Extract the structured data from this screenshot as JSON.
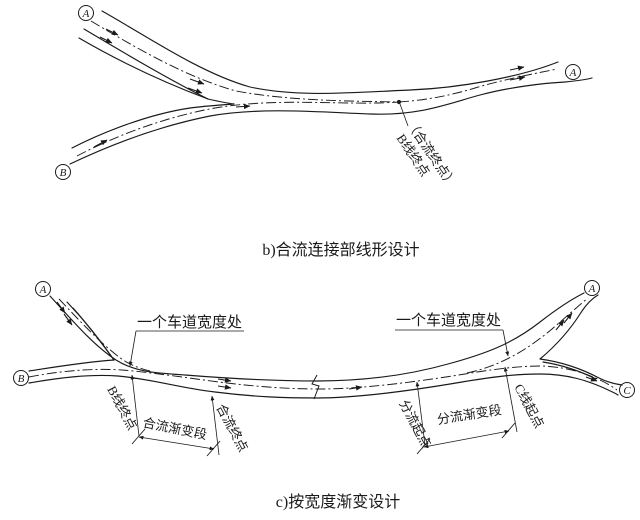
{
  "figure": {
    "caption_b": "b)合流连接部线形设计",
    "caption_c": "c)按宽度渐变设计"
  },
  "diagram_b": {
    "node_a_start": "A",
    "node_b_start": "B",
    "node_a_end": "A",
    "annotation": {
      "line1": "（合流终点）",
      "line2": "B线终点"
    }
  },
  "diagram_c": {
    "node_a_left": "A",
    "node_b": "B",
    "node_a_right": "A",
    "node_c": "C",
    "lane_width_left": "一个车道宽度处",
    "lane_width_right": "一个车道宽度处",
    "b_line_end": "B线终点",
    "merge_taper": "合流渐变段",
    "merge_end": "合流终点",
    "diverge_start": "分流起点",
    "diverge_taper": "分流渐变段",
    "c_line_start": "C线起点"
  },
  "colors": {
    "ink": "#1a1a1a",
    "background": "#ffffff"
  }
}
